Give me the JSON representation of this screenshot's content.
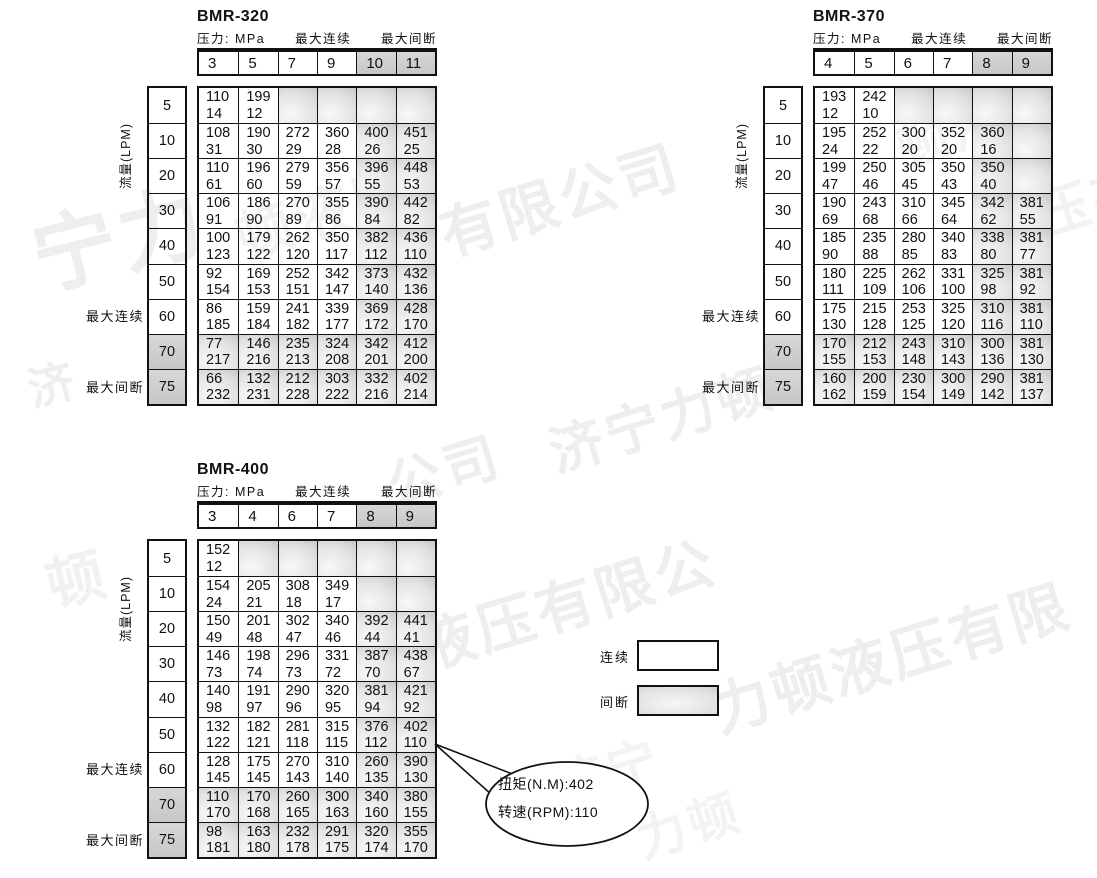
{
  "legend": {
    "continuous_label": "连续",
    "intermittent_label": "间断"
  },
  "callout": {
    "torque_line": "扭矩(N.M):402",
    "speed_line": "转速(RPM):110"
  },
  "watermark": {
    "text": "济宁力顿液压有限公司",
    "color": "#efeeee",
    "fragments": [
      {
        "text": "宁力",
        "x": 18,
        "y": 196,
        "size": 84,
        "rot": -14
      },
      {
        "text": "顿液压",
        "x": 225,
        "y": 198,
        "size": 56,
        "rot": -17,
        "color": "#f3f2f2"
      },
      {
        "text": "有限公司",
        "x": 428,
        "y": 192,
        "size": 58,
        "rot": -17
      },
      {
        "text": "济",
        "x": 20,
        "y": 356,
        "size": 46,
        "rot": -14
      },
      {
        "text": "公司",
        "x": 376,
        "y": 446,
        "size": 54,
        "rot": -17
      },
      {
        "text": "济宁力顿",
        "x": 538,
        "y": 412,
        "size": 54,
        "rot": -17
      },
      {
        "text": "顿",
        "x": 36,
        "y": 542,
        "size": 58,
        "rot": -14,
        "color": "#f2f1f1"
      },
      {
        "text": "液压有限公",
        "x": 405,
        "y": 606,
        "size": 58,
        "rot": -17
      },
      {
        "text": "力顿液压有限",
        "x": 700,
        "y": 668,
        "size": 58,
        "rot": -17
      },
      {
        "text": "济宁",
        "x": 545,
        "y": 750,
        "size": 50,
        "rot": -17,
        "color": "#f4f3f3"
      },
      {
        "text": "力顿",
        "x": 626,
        "y": 804,
        "size": 50,
        "rot": -17,
        "color": "#f4f3f3"
      },
      {
        "text": "顿液",
        "x": 886,
        "y": 110,
        "size": 52,
        "rot": -17,
        "color": "#f4f3f3"
      },
      {
        "text": "压有",
        "x": 1024,
        "y": 176,
        "size": 54,
        "rot": -17,
        "color": "#f3f2f2"
      },
      {
        "text": "济宁",
        "x": 934,
        "y": 334,
        "size": 50,
        "rot": -17,
        "color": "#f3f2f2"
      }
    ]
  },
  "tables": [
    {
      "title": "BMR-320",
      "pressure_label": "压力: MPa",
      "max_continuous_label": "最大连续",
      "max_intermittent_label": "最大间断",
      "flow_axis_label": "流量(LPM)",
      "row_max_continuous_label": "最大连续",
      "row_max_intermittent_label": "最大间断",
      "pressures": [
        "3",
        "5",
        "7",
        "9",
        "10",
        "11"
      ],
      "shaded_pressure_from_index": 4,
      "flows": [
        "5",
        "10",
        "20",
        "30",
        "40",
        "50",
        "60",
        "70",
        "75"
      ],
      "shaded_flow_from_index": 7,
      "rows": [
        [
          [
            "110",
            "14"
          ],
          [
            "199",
            "12"
          ],
          null,
          null,
          null,
          null
        ],
        [
          [
            "108",
            "31"
          ],
          [
            "190",
            "30"
          ],
          [
            "272",
            "29"
          ],
          [
            "360",
            "28"
          ],
          [
            "400",
            "26"
          ],
          [
            "451",
            "25"
          ]
        ],
        [
          [
            "110",
            "61"
          ],
          [
            "196",
            "60"
          ],
          [
            "279",
            "59"
          ],
          [
            "356",
            "57"
          ],
          [
            "396",
            "55"
          ],
          [
            "448",
            "53"
          ]
        ],
        [
          [
            "106",
            "91"
          ],
          [
            "186",
            "90"
          ],
          [
            "270",
            "89"
          ],
          [
            "355",
            "86"
          ],
          [
            "390",
            "84"
          ],
          [
            "442",
            "82"
          ]
        ],
        [
          [
            "100",
            "123"
          ],
          [
            "179",
            "122"
          ],
          [
            "262",
            "120"
          ],
          [
            "350",
            "117"
          ],
          [
            "382",
            "112"
          ],
          [
            "436",
            "110"
          ]
        ],
        [
          [
            "92",
            "154"
          ],
          [
            "169",
            "153"
          ],
          [
            "252",
            "151"
          ],
          [
            "342",
            "147"
          ],
          [
            "373",
            "140"
          ],
          [
            "432",
            "136"
          ]
        ],
        [
          [
            "86",
            "185"
          ],
          [
            "159",
            "184"
          ],
          [
            "241",
            "182"
          ],
          [
            "339",
            "177"
          ],
          [
            "369",
            "172"
          ],
          [
            "428",
            "170"
          ]
        ],
        [
          [
            "77",
            "217"
          ],
          [
            "146",
            "216"
          ],
          [
            "235",
            "213"
          ],
          [
            "324",
            "208"
          ],
          [
            "342",
            "201"
          ],
          [
            "412",
            "200"
          ]
        ],
        [
          [
            "66",
            "232"
          ],
          [
            "132",
            "231"
          ],
          [
            "212",
            "228"
          ],
          [
            "303",
            "222"
          ],
          [
            "332",
            "216"
          ],
          [
            "402",
            "214"
          ]
        ]
      ]
    },
    {
      "title": "BMR-370",
      "pressure_label": "压力: MPa",
      "max_continuous_label": "最大连续",
      "max_intermittent_label": "最大间断",
      "flow_axis_label": "流量(LPM)",
      "row_max_continuous_label": "最大连续",
      "row_max_intermittent_label": "最大间断",
      "pressures": [
        "4",
        "5",
        "6",
        "7",
        "8",
        "9"
      ],
      "shaded_pressure_from_index": 4,
      "flows": [
        "5",
        "10",
        "20",
        "30",
        "40",
        "50",
        "60",
        "70",
        "75"
      ],
      "shaded_flow_from_index": 7,
      "rows": [
        [
          [
            "193",
            "12"
          ],
          [
            "242",
            "10"
          ],
          null,
          null,
          null,
          null
        ],
        [
          [
            "195",
            "24"
          ],
          [
            "252",
            "22"
          ],
          [
            "300",
            "20"
          ],
          [
            "352",
            "20"
          ],
          [
            "360",
            "16"
          ],
          null
        ],
        [
          [
            "199",
            "47"
          ],
          [
            "250",
            "46"
          ],
          [
            "305",
            "45"
          ],
          [
            "350",
            "43"
          ],
          [
            "350",
            "40"
          ],
          null
        ],
        [
          [
            "190",
            "69"
          ],
          [
            "243",
            "68"
          ],
          [
            "310",
            "66"
          ],
          [
            "345",
            "64"
          ],
          [
            "342",
            "62"
          ],
          [
            "381",
            "55"
          ]
        ],
        [
          [
            "185",
            "90"
          ],
          [
            "235",
            "88"
          ],
          [
            "280",
            "85"
          ],
          [
            "340",
            "83"
          ],
          [
            "338",
            "80"
          ],
          [
            "381",
            "77"
          ]
        ],
        [
          [
            "180",
            "111"
          ],
          [
            "225",
            "109"
          ],
          [
            "262",
            "106"
          ],
          [
            "331",
            "100"
          ],
          [
            "325",
            "98"
          ],
          [
            "381",
            "92"
          ]
        ],
        [
          [
            "175",
            "130"
          ],
          [
            "215",
            "128"
          ],
          [
            "253",
            "125"
          ],
          [
            "325",
            "120"
          ],
          [
            "310",
            "116"
          ],
          [
            "381",
            "110"
          ]
        ],
        [
          [
            "170",
            "155"
          ],
          [
            "212",
            "153"
          ],
          [
            "243",
            "148"
          ],
          [
            "310",
            "143"
          ],
          [
            "300",
            "136"
          ],
          [
            "381",
            "130"
          ]
        ],
        [
          [
            "160",
            "162"
          ],
          [
            "200",
            "159"
          ],
          [
            "230",
            "154"
          ],
          [
            "300",
            "149"
          ],
          [
            "290",
            "142"
          ],
          [
            "381",
            "137"
          ]
        ]
      ]
    },
    {
      "title": "BMR-400",
      "pressure_label": "压力: MPa",
      "max_continuous_label": "最大连续",
      "max_intermittent_label": "最大间断",
      "flow_axis_label": "流量(LPM)",
      "row_max_continuous_label": "最大连续",
      "row_max_intermittent_label": "最大间断",
      "pressures": [
        "3",
        "4",
        "6",
        "7",
        "8",
        "9"
      ],
      "shaded_pressure_from_index": 4,
      "flows": [
        "5",
        "10",
        "20",
        "30",
        "40",
        "50",
        "60",
        "70",
        "75"
      ],
      "shaded_flow_from_index": 7,
      "rows": [
        [
          [
            "152",
            "12"
          ],
          null,
          null,
          null,
          null,
          null
        ],
        [
          [
            "154",
            "24"
          ],
          [
            "205",
            "21"
          ],
          [
            "308",
            "18"
          ],
          [
            "349",
            "17"
          ],
          null,
          null
        ],
        [
          [
            "150",
            "49"
          ],
          [
            "201",
            "48"
          ],
          [
            "302",
            "47"
          ],
          [
            "340",
            "46"
          ],
          [
            "392",
            "44"
          ],
          [
            "441",
            "41"
          ]
        ],
        [
          [
            "146",
            "73"
          ],
          [
            "198",
            "74"
          ],
          [
            "296",
            "73"
          ],
          [
            "331",
            "72"
          ],
          [
            "387",
            "70"
          ],
          [
            "438",
            "67"
          ]
        ],
        [
          [
            "140",
            "98"
          ],
          [
            "191",
            "97"
          ],
          [
            "290",
            "96"
          ],
          [
            "320",
            "95"
          ],
          [
            "381",
            "94"
          ],
          [
            "421",
            "92"
          ]
        ],
        [
          [
            "132",
            "122"
          ],
          [
            "182",
            "121"
          ],
          [
            "281",
            "118"
          ],
          [
            "315",
            "115"
          ],
          [
            "376",
            "112"
          ],
          [
            "402",
            "110"
          ]
        ],
        [
          [
            "128",
            "145"
          ],
          [
            "175",
            "145"
          ],
          [
            "270",
            "143"
          ],
          [
            "310",
            "140"
          ],
          [
            "260",
            "135"
          ],
          [
            "390",
            "130"
          ]
        ],
        [
          [
            "110",
            "170"
          ],
          [
            "170",
            "168"
          ],
          [
            "260",
            "165"
          ],
          [
            "300",
            "163"
          ],
          [
            "340",
            "160"
          ],
          [
            "380",
            "155"
          ]
        ],
        [
          [
            "98",
            "181"
          ],
          [
            "163",
            "180"
          ],
          [
            "232",
            "178"
          ],
          [
            "291",
            "175"
          ],
          [
            "320",
            "174"
          ],
          [
            "355",
            "170"
          ]
        ]
      ]
    }
  ]
}
